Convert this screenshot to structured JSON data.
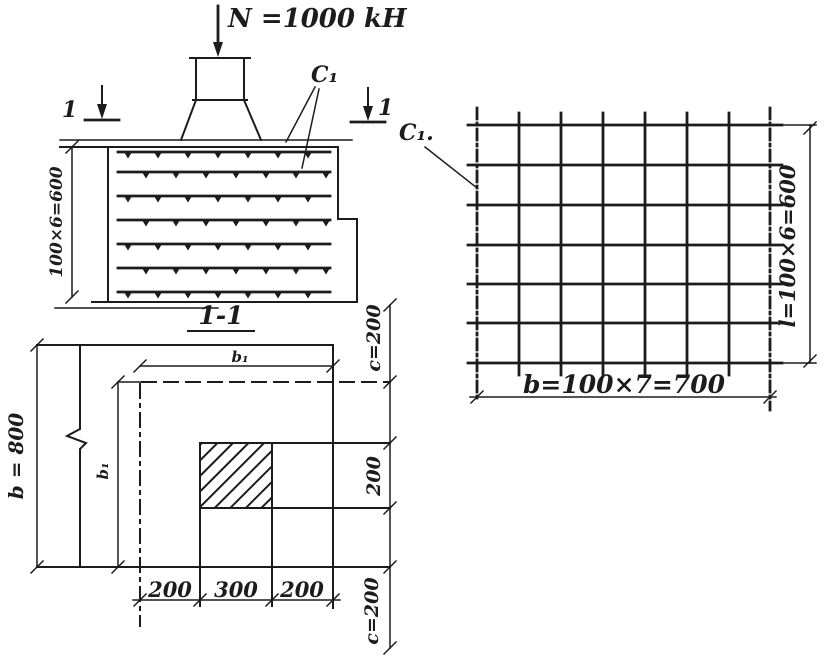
{
  "colors": {
    "ink": "#1c1c1c",
    "paper": "#ffffff"
  },
  "load_label": "N =1000 kH",
  "section": {
    "cut_digit_left": "1",
    "cut_digit_right": "1",
    "mesh_ref": "C₁",
    "dim_height": "100×6=600",
    "caption": "1-1",
    "mesh_layers": 7
  },
  "plan": {
    "dim_width": "b = 800",
    "dim_inner_top": "b₁",
    "dim_inner_left": "b₁",
    "dim_bottom": [
      "200",
      "300",
      "200"
    ],
    "dim_right": [
      "c=200",
      "200",
      "c=200"
    ]
  },
  "mesh": {
    "label": "C₁.",
    "dim_width": "b=100×7=700",
    "dim_height": "l=100×6=600",
    "vertical_bars": 8,
    "horizontal_bars": 7
  }
}
